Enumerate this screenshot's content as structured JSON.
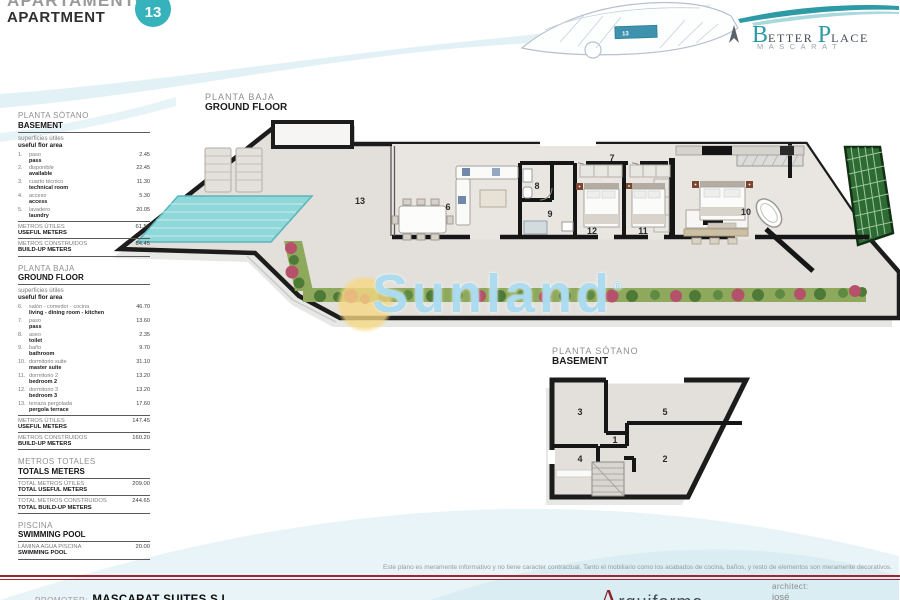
{
  "header": {
    "title_es": "APARTAMENTO",
    "title_en": "APARTMENT",
    "unit_number": "13"
  },
  "brand": {
    "b": "B",
    "etter": "ETTER",
    "p": "P",
    "lace": "LACE",
    "subtitle": "MASCARAT"
  },
  "site_plan": {
    "unit_label": "13"
  },
  "watermark": {
    "text": "Sunland",
    "registered": "®"
  },
  "colors": {
    "accent_teal": "#35b2bc",
    "pool": "#8ed8da",
    "garden": "#8fa95c",
    "wall": "#1c1c1c",
    "floor": "#e3e0db",
    "footer_red": "#9e2633",
    "watermark_blue": "#7ac6e9",
    "sun_yellow": "#f6d882"
  },
  "ground_floor": {
    "title_es": "PLANTA BAJA",
    "title_en": "GROUND FLOOR",
    "room_labels": {
      "r6": "6",
      "r7": "7",
      "r8": "8",
      "r9": "9",
      "r10": "10",
      "r11": "11",
      "r12": "12",
      "r13": "13"
    }
  },
  "basement_plan": {
    "title_es": "PLANTA SÓTANO",
    "title_en": "BASEMENT",
    "room_labels": {
      "r1": "1",
      "r2": "2",
      "r3": "3",
      "r4": "4",
      "r5": "5"
    }
  },
  "sidebar": {
    "sections": [
      {
        "title_es": "PLANTA SÓTANO",
        "title_en": "BASEMENT",
        "subtitle_es": "superficies útiles",
        "subtitle_en": "useful flor area",
        "items": [
          {
            "num": "1.",
            "es": "paso",
            "en": "pass",
            "value": "2.45"
          },
          {
            "num": "2.",
            "es": "disponible",
            "en": "available",
            "value": "22.45"
          },
          {
            "num": "3.",
            "es": "cuarto técnico",
            "en": "technical room",
            "value": "11.30"
          },
          {
            "num": "4.",
            "es": "acceso",
            "en": "access",
            "value": "5.30"
          },
          {
            "num": "5.",
            "es": "lavadero",
            "en": "laundry",
            "value": "20.05"
          }
        ],
        "totals": [
          {
            "es": "METROS ÚTILES",
            "en": "USEFUL METERS",
            "value": "61.55"
          },
          {
            "es": "METROS CONSTRUIDOS",
            "en": "BUILD-UP METERS",
            "value": "84.45"
          }
        ]
      },
      {
        "title_es": "PLANTA BAJA",
        "title_en": "GROUND FLOOR",
        "subtitle_es": "superficies útiles",
        "subtitle_en": "useful flor area",
        "items": [
          {
            "num": "6.",
            "es": "salón - comedor - cocina",
            "en": "living - dining room - kitchen",
            "value": "46.70"
          },
          {
            "num": "7.",
            "es": "paso",
            "en": "pass",
            "value": "13.60"
          },
          {
            "num": "8.",
            "es": "aseo",
            "en": "toilet",
            "value": "2.35"
          },
          {
            "num": "9.",
            "es": "baño",
            "en": "bathroom",
            "value": "9.70"
          },
          {
            "num": "10.",
            "es": "dormitorio suite",
            "en": "master suite",
            "value": "31.10"
          },
          {
            "num": "11.",
            "es": "dormitorio 2",
            "en": "bedroom 2",
            "value": "13.20"
          },
          {
            "num": "12.",
            "es": "dormitorio 3",
            "en": "bedroom 3",
            "value": "13.20"
          },
          {
            "num": "13.",
            "es": "terraza pergolada",
            "en": "pergola terrace",
            "value": "17.60"
          }
        ],
        "totals": [
          {
            "es": "METROS ÚTILES",
            "en": "USEFUL METERS",
            "value": "147.45"
          },
          {
            "es": "METROS CONSTRUIDOS",
            "en": "BUILD-UP METERS",
            "value": "160.20"
          }
        ]
      },
      {
        "title_es": "METROS TOTALES",
        "title_en": "TOTALS METERS",
        "subtitle_es": "",
        "subtitle_en": "",
        "items": [],
        "totals": [
          {
            "es": "TOTAL METROS ÚTILES",
            "en": "TOTAL USEFUL METERS",
            "value": "209.00"
          },
          {
            "es": "TOTAL METROS CONSTRUIDOS",
            "en": "TOTAL BUILD-UP METERS",
            "value": "244.65"
          }
        ]
      },
      {
        "title_es": "PISCINA",
        "title_en": "SWIMMING POOL",
        "subtitle_es": "",
        "subtitle_en": "",
        "items": [],
        "totals": [
          {
            "es": "LÁMINA AGUA PISCINA",
            "en": "SWIMMING POOL",
            "value": "20.00"
          }
        ]
      }
    ]
  },
  "footer": {
    "disclaimer": "Este plano es meramente informativo y no tiene caracter contractual. Tanto el mobiliario como los acabados de cocina, baños, y resto de elementos son meramente decorativos.",
    "promoter_label": "PROMOTER:",
    "promoter_name": "MASCARAT SUITES S.L.",
    "studio_initial": "A",
    "studio_rest": "rquiforma",
    "architect_label": "architect:",
    "architect_name": "josé"
  }
}
